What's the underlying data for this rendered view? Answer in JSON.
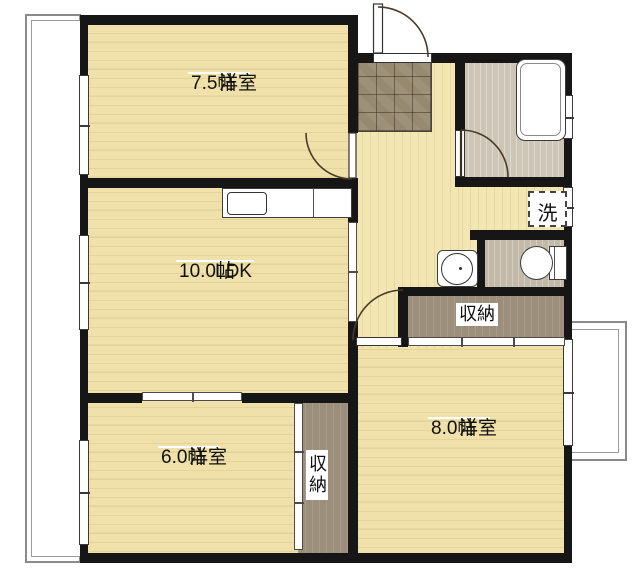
{
  "plan_title": "2LDK apartment floor plan",
  "colors": {
    "wall": "#161616",
    "room_floor": "#efe1a9",
    "hall_floor": "#f2e6b3",
    "entry_tile": "#97896f",
    "bath_floor": "#cdc5b6",
    "toilet_floor": "#c3b9a8",
    "closet_floor": "#9b8e7b",
    "door_arc": "#4a3b28"
  },
  "labels": {
    "room_75": {
      "name": "洋室",
      "size": "7.5帖"
    },
    "room_ldk": {
      "name": "LDK",
      "size": "10.0帖"
    },
    "room_60": {
      "name": "洋室",
      "size": "6.0帖"
    },
    "room_80": {
      "name": "洋室",
      "size": "8.0帖"
    },
    "closet_upper": "収納",
    "closet_lower": "収納",
    "laundry": "洗"
  }
}
